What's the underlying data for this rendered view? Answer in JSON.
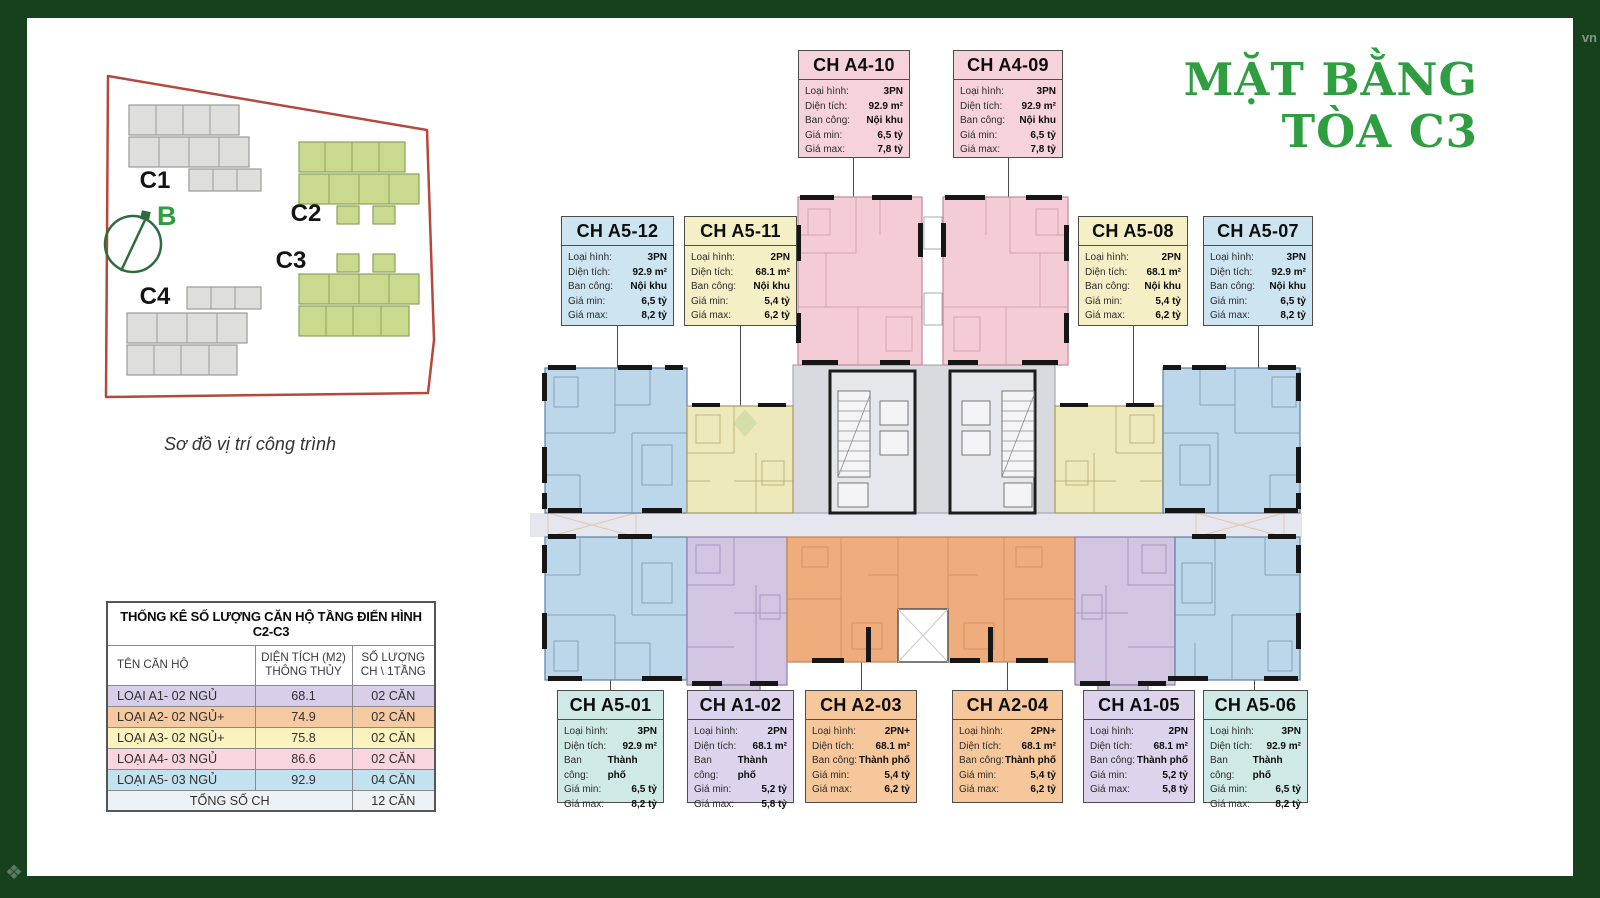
{
  "page": {
    "title_line1": "MẶT BẰNG",
    "title_line2": "TÒA C3"
  },
  "watermarks": {
    "top_right": "vn"
  },
  "palette": {
    "frame-green": "#17411d",
    "green": "#2f9e41",
    "card-pink": "#f6d2da",
    "card-blue": "#cde4f1",
    "card-teal": "#cfe9e6",
    "card-yellow": "#f5efc5",
    "card-purple": "#ddd3ec",
    "card-orange": "#f6c79b",
    "floor-pink": "#f3ccd5",
    "floor-blue": "#bdd7ea",
    "floor-yellow": "#eee9ba",
    "floor-purple": "#d2c5e2",
    "floor-orange": "#efad7d",
    "core-gray": "#d9dae0",
    "corridor": "#e6e6ee",
    "site-red": "#b5483c",
    "site-green-fill": "#c9da8f",
    "site-green-stroke": "#8aa35a",
    "site-gray-fill": "#dededc",
    "site-gray-stroke": "#9a9a98",
    "compass-green": "#2e6b3f",
    "tbl-purple": "#d9cee9",
    "tbl-orange": "#f6c9a0",
    "tbl-yellow": "#fbf2be",
    "tbl-pink": "#f9d5df",
    "tbl-blue": "#c3e1ee",
    "tbl-total": "#edf2f6"
  },
  "site_map": {
    "caption": "Sơ đồ vị trí công trình",
    "compass_label": "B",
    "buildings": [
      {
        "id": "C1"
      },
      {
        "id": "C2"
      },
      {
        "id": "C3"
      },
      {
        "id": "C4"
      }
    ]
  },
  "stats_table": {
    "title": "THỐNG KÊ SỐ LƯỢNG CĂN HỘ TẦNG ĐIỂN HÌNH C2-C3",
    "columns": {
      "name": "TÊN CĂN HỘ",
      "area_line1": "DIỆN TÍCH (M2)",
      "area_line2": "THÔNG THỦY",
      "count_line1": "SỐ LƯỢNG",
      "count_line2": "CH \\ 1TẦNG"
    },
    "rows": [
      {
        "name": "LOẠI A1- 02 NGỦ",
        "area": "68.1",
        "count": "02 CĂN"
      },
      {
        "name": "LOẠI A2- 02 NGỦ+",
        "area": "74.9",
        "count": "02 CĂN"
      },
      {
        "name": "LOẠI A3- 02 NGỦ+",
        "area": "75.8",
        "count": "02 CĂN"
      },
      {
        "name": "LOẠI A4- 03 NGỦ",
        "area": "86.6",
        "count": "02 CĂN"
      },
      {
        "name": "LOẠI A5- 03 NGỦ",
        "area": "92.9",
        "count": "04 CĂN"
      }
    ],
    "total_label": "TỔNG SỐ CH",
    "total_value": "12 CĂN"
  },
  "field_labels": {
    "type": "Loại hình:",
    "area": "Diện tích:",
    "balcony": "Ban công:",
    "price_min": "Giá min:",
    "price_max": "Giá max:"
  },
  "units": [
    {
      "id": "CH A4-10",
      "type": "3PN",
      "area": "92.9 m²",
      "balcony": "Nội khu",
      "price_min": "6,5 tỷ",
      "price_max": "7,8 tỷ",
      "color": "#f6d2da"
    },
    {
      "id": "CH A4-09",
      "type": "3PN",
      "area": "92.9 m²",
      "balcony": "Nội khu",
      "price_min": "6,5 tỷ",
      "price_max": "7,8 tỷ",
      "color": "#f6d2da"
    },
    {
      "id": "CH A5-12",
      "type": "3PN",
      "area": "92.9 m²",
      "balcony": "Nội khu",
      "price_min": "6,5 tỷ",
      "price_max": "8,2 tỷ",
      "color": "#cde4f1"
    },
    {
      "id": "CH A5-11",
      "type": "2PN",
      "area": "68.1 m²",
      "balcony": "Nội khu",
      "price_min": "5,4 tỷ",
      "price_max": "6,2 tỷ",
      "color": "#f5efc5"
    },
    {
      "id": "CH A5-08",
      "type": "2PN",
      "area": "68.1 m²",
      "balcony": "Nội khu",
      "price_min": "5,4 tỷ",
      "price_max": "6,2 tỷ",
      "color": "#f5efc5"
    },
    {
      "id": "CH A5-07",
      "type": "3PN",
      "area": "92.9 m²",
      "balcony": "Nội khu",
      "price_min": "6,5 tỷ",
      "price_max": "8,2 tỷ",
      "color": "#cde4f1"
    },
    {
      "id": "CH A5-01",
      "type": "3PN",
      "area": "92.9 m²",
      "balcony": "Thành phố",
      "price_min": "6,5 tỷ",
      "price_max": "8,2 tỷ",
      "color": "#cfe9e6"
    },
    {
      "id": "CH A1-02",
      "type": "2PN",
      "area": "68.1 m²",
      "balcony": "Thành phố",
      "price_min": "5,2 tỷ",
      "price_max": "5,8 tỷ",
      "color": "#ddd3ec"
    },
    {
      "id": "CH A2-03",
      "type": "2PN+",
      "area": "68.1 m²",
      "balcony": "Thành phố",
      "price_min": "5,4 tỷ",
      "price_max": "6,2 tỷ",
      "color": "#f6c79b"
    },
    {
      "id": "CH A2-04",
      "type": "2PN+",
      "area": "68.1 m²",
      "balcony": "Thành phố",
      "price_min": "5,4 tỷ",
      "price_max": "6,2 tỷ",
      "color": "#f6c79b"
    },
    {
      "id": "CH A1-05",
      "type": "2PN",
      "area": "68.1 m²",
      "balcony": "Thành phố",
      "price_min": "5,2 tỷ",
      "price_max": "5,8 tỷ",
      "color": "#ddd3ec"
    },
    {
      "id": "CH A5-06",
      "type": "3PN",
      "area": "92.9 m²",
      "balcony": "Thành phố",
      "price_min": "6,5 tỷ",
      "price_max": "8,2 tỷ",
      "color": "#cfe9e6"
    }
  ]
}
